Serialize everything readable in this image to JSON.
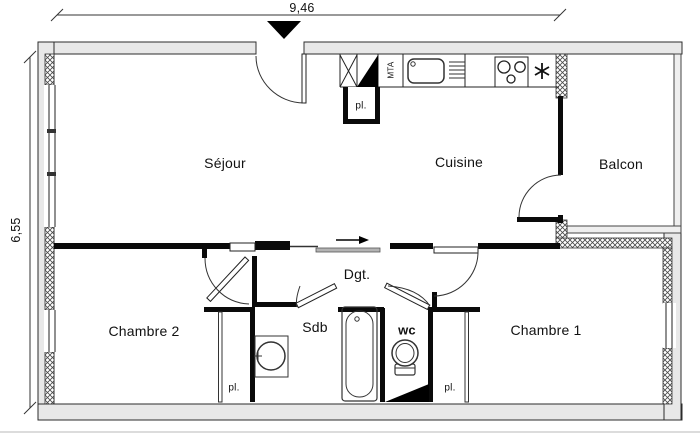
{
  "dimensions": {
    "width_m": "9,46",
    "height_m": "6,55"
  },
  "rooms": {
    "sejour": {
      "label": "Séjour"
    },
    "cuisine": {
      "label": "Cuisine"
    },
    "balcon": {
      "label": "Balcon"
    },
    "chambre1": {
      "label": "Chambre 1"
    },
    "chambre2": {
      "label": "Chambre 2"
    },
    "sdb": {
      "label": "Sdb"
    },
    "wc": {
      "label": "wc"
    },
    "dgt": {
      "label": "Dgt."
    }
  },
  "annotations": {
    "closet": "pl.",
    "duct": "MTA"
  },
  "colors": {
    "wall_fill": "#e8e8e8",
    "wall_outline": "#2b2b2b",
    "partition": "#0a0a0a",
    "paper": "#ffffff"
  }
}
